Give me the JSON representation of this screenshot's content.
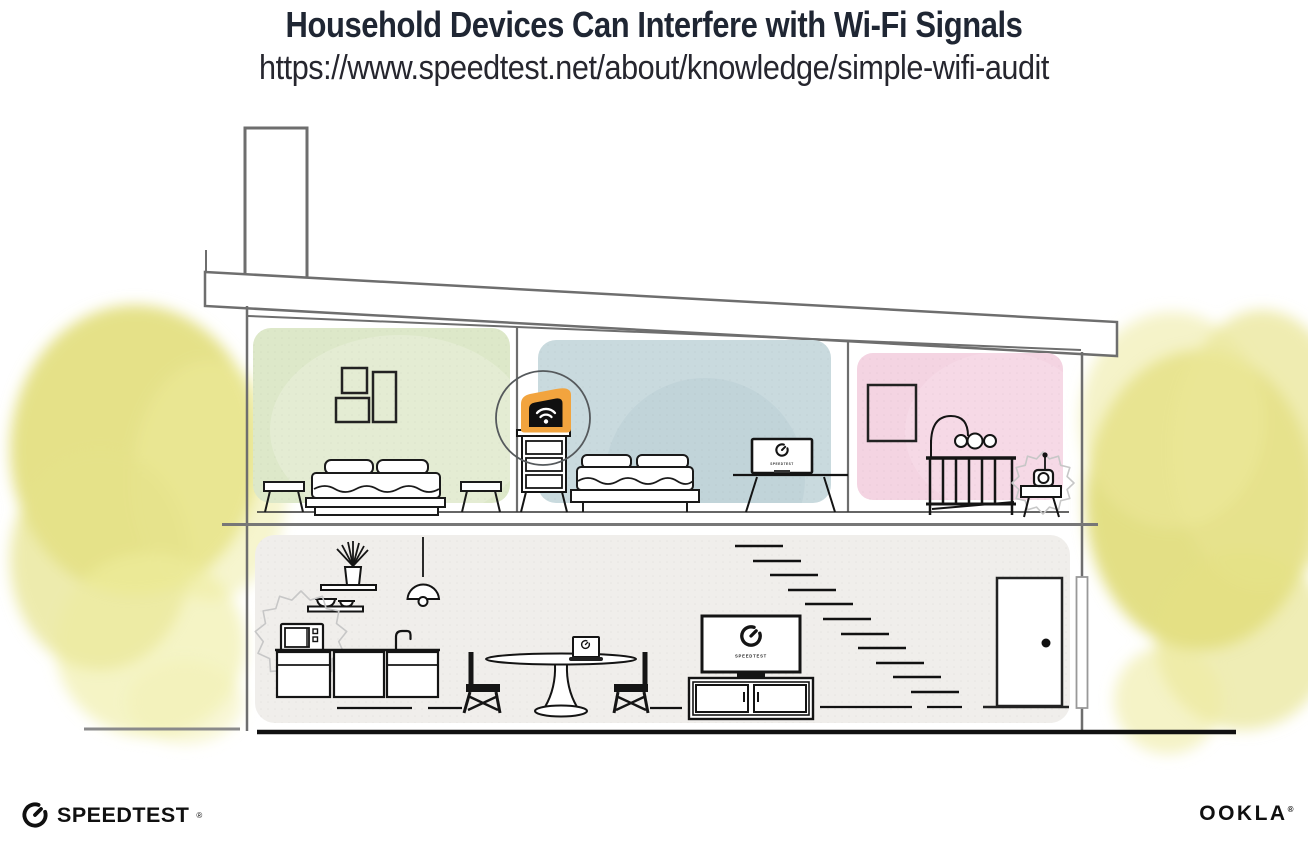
{
  "header": {
    "title": "Household Devices Can Interfere with Wi-Fi Signals",
    "url": "https://www.speedtest.net/about/knowledge/simple-wifi-audit"
  },
  "branding": {
    "speedtest_wordmark": "SPEEDTEST",
    "speedtest_trademark": "®",
    "ookla_wordmark": "OOKLA",
    "ookla_trademark": "®"
  },
  "illustration": {
    "screens": {
      "monitor_label": "SPEEDTEST",
      "tv_label": "SPEEDTEST"
    },
    "colors": {
      "router_highlight": "#F2A43E",
      "bedroom_left_wall": "#DDE8C9",
      "bedroom_middle_wall": "#C9DADE",
      "nursery_wall": "#F4D4E2",
      "living_area_wall": "#F0EEEB",
      "foliage": "#E2DE7B",
      "structure_line": "#6E6E6E",
      "furniture_line": "#141414",
      "title_text": "#1F2633"
    }
  }
}
